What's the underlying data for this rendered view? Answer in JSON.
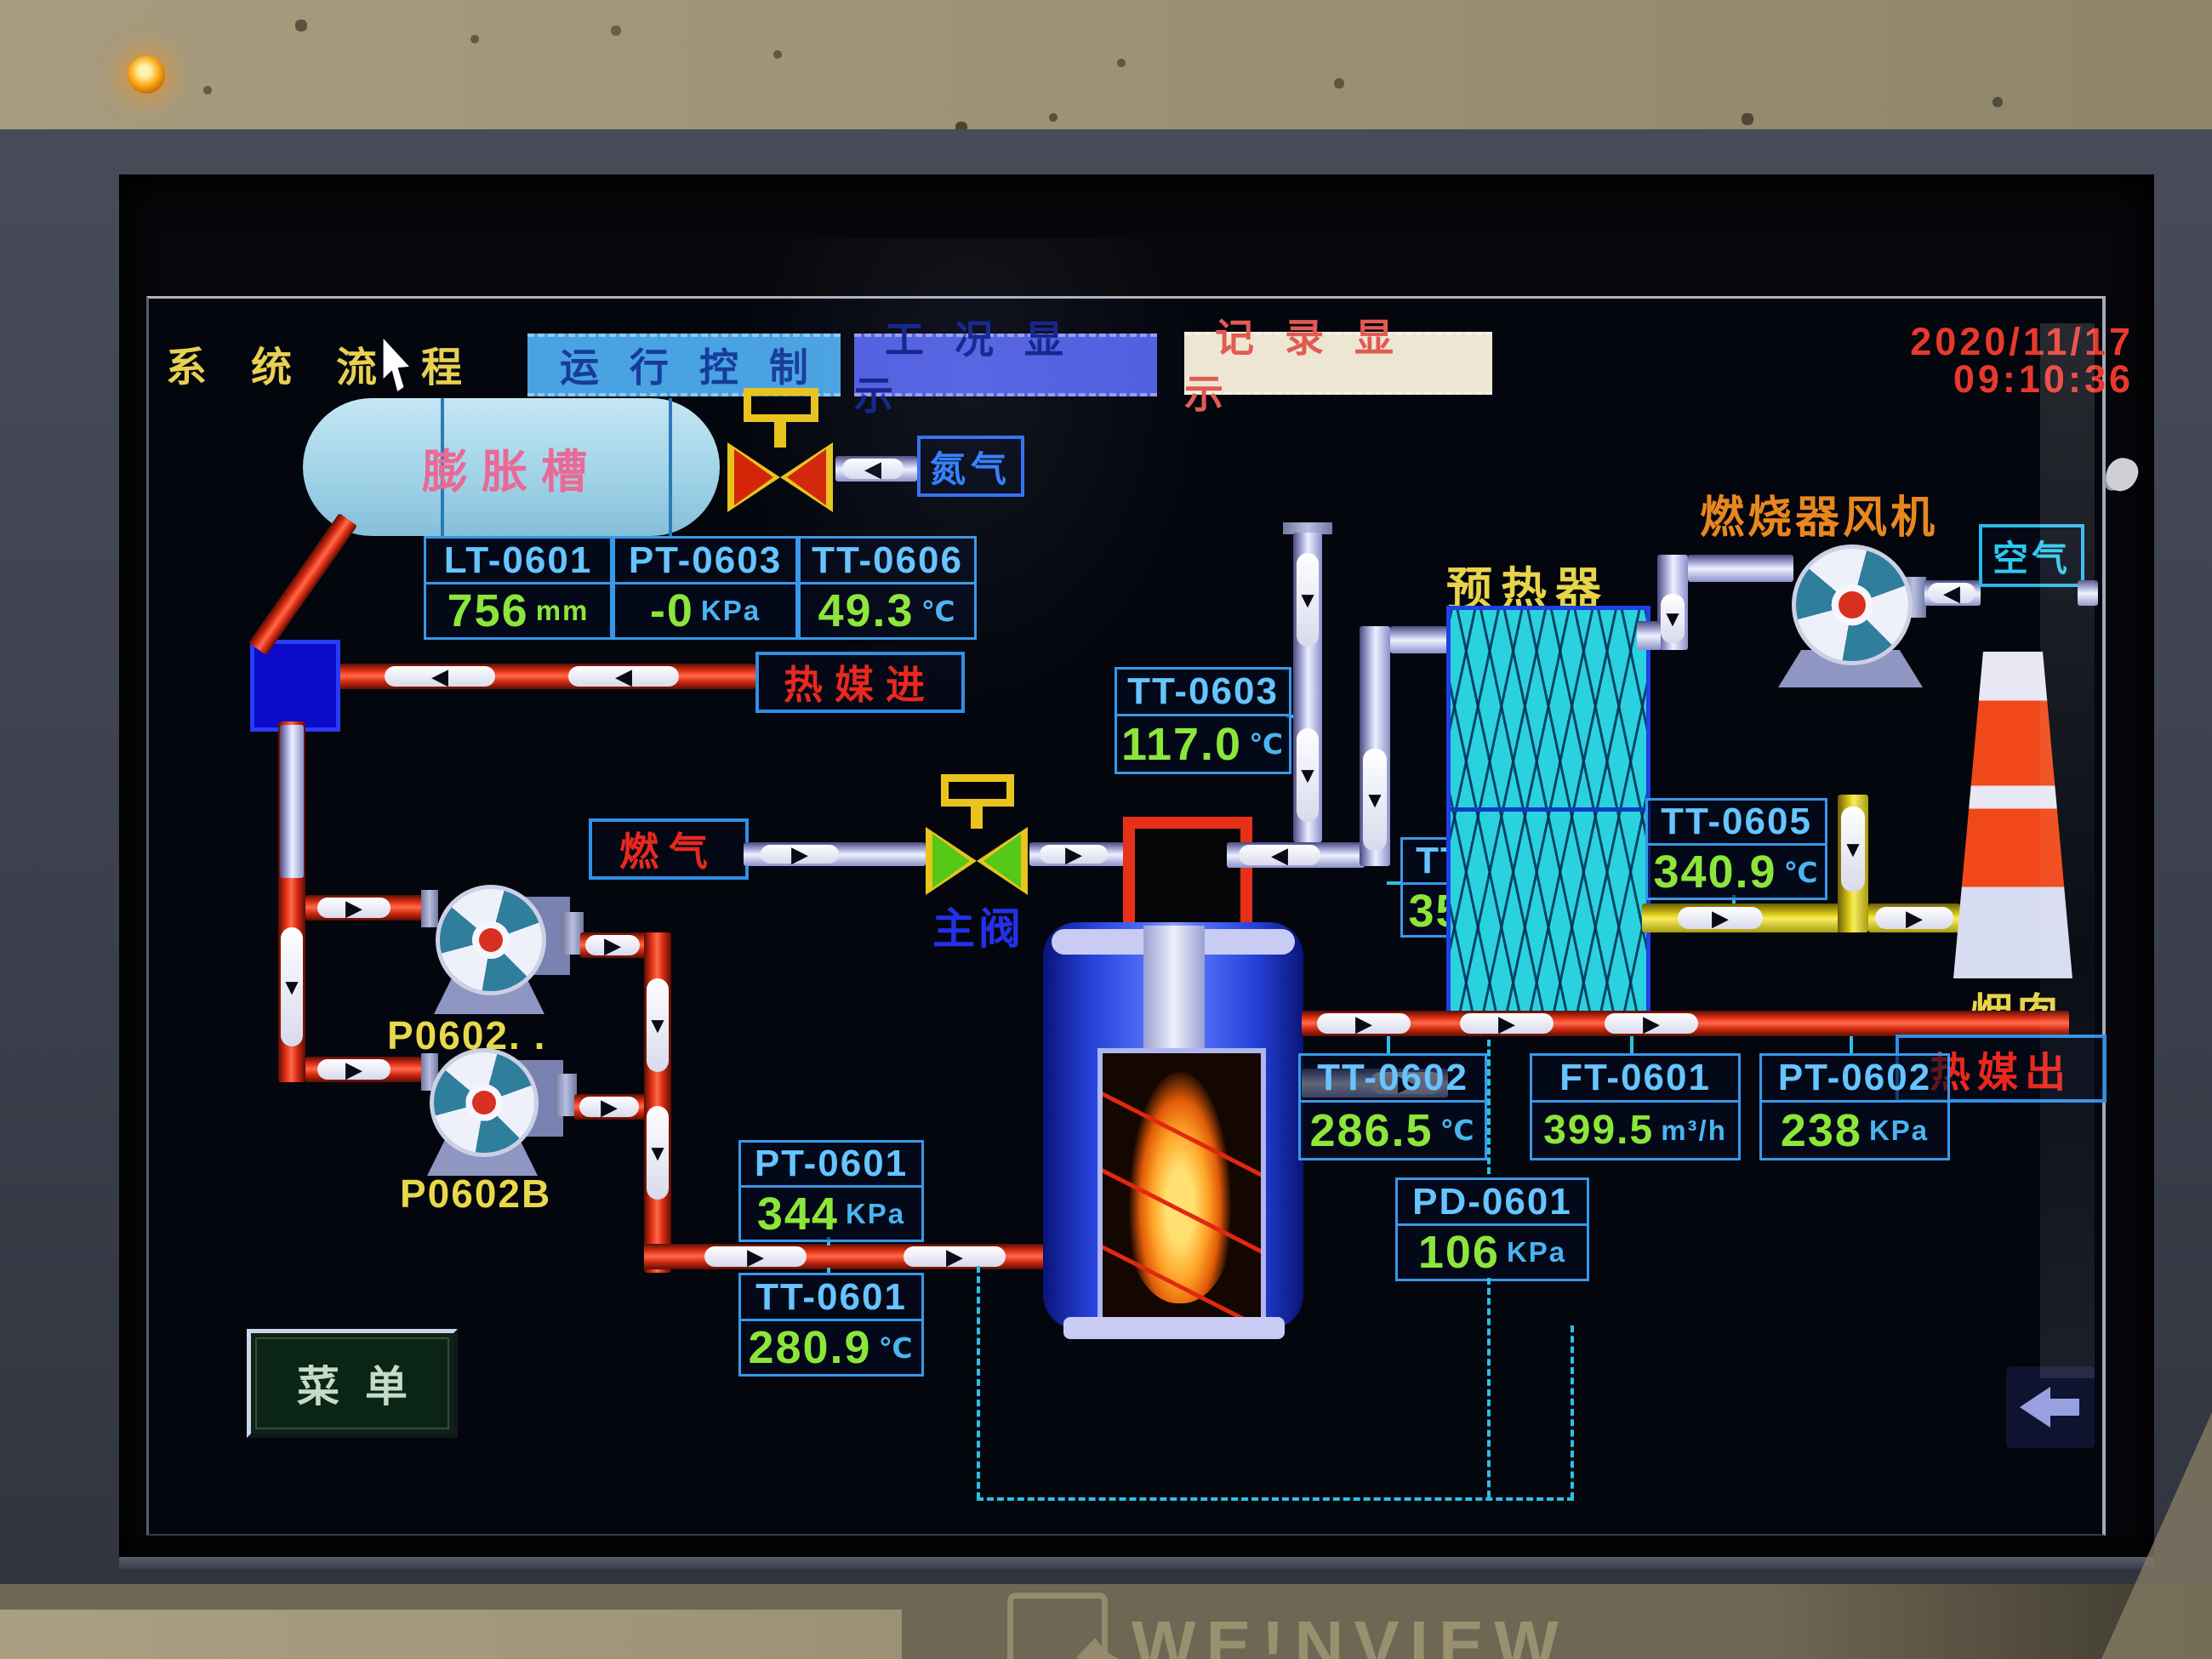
{
  "nav": {
    "tabs": [
      {
        "label": "系统流程"
      },
      {
        "label": "运行控制"
      },
      {
        "label": "工况显示"
      },
      {
        "label": "记录显示"
      }
    ]
  },
  "datetime": {
    "date": "2020/11/17",
    "time": "09:10:36"
  },
  "labels": {
    "expansion_tank": "膨胀槽",
    "nitrogen": "氮气",
    "heat_medium_in": "热媒进",
    "fuel_gas": "燃气",
    "main_valve": "主阀",
    "preheater": "预热器",
    "burner_fan": "燃烧器风机",
    "air": "空气",
    "chimney": "烟囱",
    "heat_medium_out": "热媒出",
    "menu": "菜单",
    "pump_a": "P0602. .",
    "pump_b": "P0602B",
    "brand": "WE!NVIEW"
  },
  "gauges": [
    {
      "id": "LT-0601",
      "value": "756",
      "unit": "mm"
    },
    {
      "id": "PT-0603",
      "value": "-0",
      "unit": "KPa"
    },
    {
      "id": "TT-0606",
      "value": "49.3",
      "unit": "℃"
    },
    {
      "id": "TT-0603",
      "value": "117.0",
      "unit": "℃"
    },
    {
      "id": "TT-0604",
      "value": "355.4",
      "unit": "℃"
    },
    {
      "id": "TT-0605",
      "value": "340.9",
      "unit": "℃"
    },
    {
      "id": "PT-0601",
      "value": "344",
      "unit": "KPa"
    },
    {
      "id": "TT-0601",
      "value": "280.9",
      "unit": "℃"
    },
    {
      "id": "TT-0602",
      "value": "286.5",
      "unit": "℃"
    },
    {
      "id": "FT-0601",
      "value": "399.5",
      "unit": "m³/h"
    },
    {
      "id": "PT-0602",
      "value": "238",
      "unit": "KPa"
    },
    {
      "id": "PD-0601",
      "value": "106",
      "unit": "KPa"
    }
  ]
}
